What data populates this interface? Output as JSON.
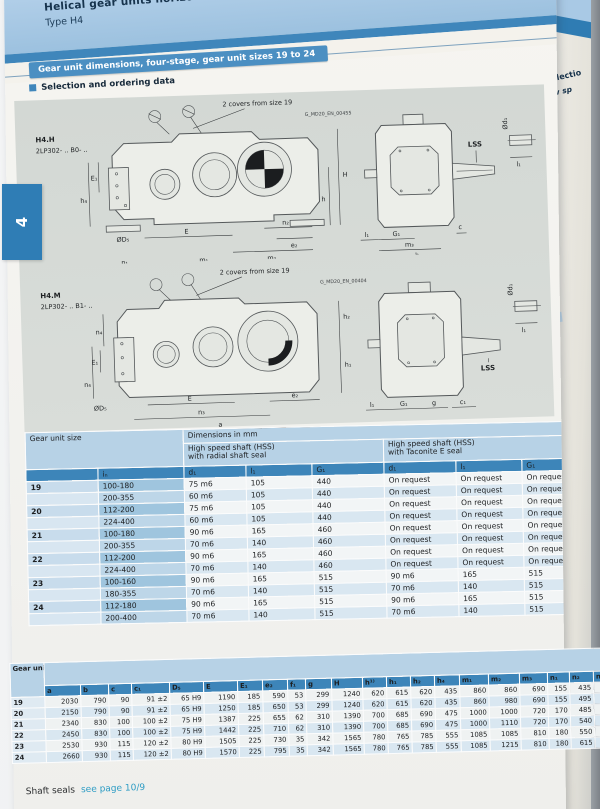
{
  "page_tab": "4",
  "header": {
    "title": "Helical gear units horizontal mounting positio",
    "subtitle": "Type H4",
    "banner": "Gear unit dimensions, four-stage, gear unit sizes 19 to 24",
    "section": "Selection and ordering data"
  },
  "drawing_top": {
    "model": "H4.H",
    "code": "2LP302- .. B0- ..",
    "note": "2 covers from size 19",
    "doc_id": "G_MD20_EN_00455",
    "lss": "LSS",
    "labels": {
      "E1": "E₁",
      "h4": "h₄",
      "n1": "n₁",
      "f1": "f₁",
      "m1": "m₁",
      "a": "a",
      "D5": "ØD₅",
      "E": "E",
      "n2": "n₂",
      "e2": "e₂",
      "m2": "m₂",
      "H": "H",
      "h": "h",
      "d1": "Ød₁",
      "l1": "l₁",
      "G1": "G₁",
      "m3": "m₃",
      "b": "b",
      "c": "c",
      "l1b": "l₁"
    }
  },
  "drawing_bottom": {
    "model": "H4.M",
    "code": "2LP302- .. B1- ..",
    "note": "2 covers from size 19",
    "doc_id": "G_MD20_EN_00404",
    "lss": "LSS",
    "labels": {
      "n4a": "n₄",
      "E1": "E₁",
      "n4b": "n₄",
      "D5": "ØD₅",
      "E": "E",
      "n3": "n₃",
      "a": "a",
      "e2": "e₂",
      "h2": "h₂",
      "h1": "h₁",
      "d1": "Ød₁",
      "l1": "l₁",
      "G1": "G₁",
      "g": "g",
      "c1": "c₁",
      "l1b": "l₁"
    }
  },
  "table1": {
    "corner": "Gear unit size",
    "dims_title": "Dimensions in mm",
    "group1a": "High speed shaft (HSS)",
    "group1b": "with radial shaft seal",
    "group2a": "High speed shaft (HSS)",
    "group2b": "with Taconite E seal",
    "cols": [
      "iₙ",
      "d₁",
      "l₁",
      "G₁",
      "d₁",
      "l₁",
      "G₁"
    ],
    "rows": [
      {
        "size": "19",
        "in": "100-180",
        "cells": [
          "75 m6",
          "105",
          "440",
          "On request",
          "On request",
          "On request"
        ]
      },
      {
        "size": "",
        "in": "200-355",
        "cells": [
          "60 m6",
          "105",
          "440",
          "On request",
          "On request",
          "On request"
        ]
      },
      {
        "size": "20",
        "in": "112-200",
        "cells": [
          "75 m6",
          "105",
          "440",
          "On request",
          "On request",
          "On request"
        ]
      },
      {
        "size": "",
        "in": "224-400",
        "cells": [
          "60 m6",
          "105",
          "440",
          "On request",
          "On request",
          "On request"
        ]
      },
      {
        "size": "21",
        "in": "100-180",
        "cells": [
          "90 m6",
          "165",
          "460",
          "On request",
          "On request",
          "On request"
        ]
      },
      {
        "size": "",
        "in": "200-355",
        "cells": [
          "70 m6",
          "140",
          "460",
          "On request",
          "On request",
          "On request"
        ]
      },
      {
        "size": "22",
        "in": "112-200",
        "cells": [
          "90 m6",
          "165",
          "460",
          "On request",
          "On request",
          "On request"
        ]
      },
      {
        "size": "",
        "in": "224-400",
        "cells": [
          "70 m6",
          "140",
          "460",
          "On request",
          "On request",
          "On request"
        ]
      },
      {
        "size": "23",
        "in": "100-160",
        "cells": [
          "90 m6",
          "165",
          "515",
          "90 m6",
          "165",
          "515"
        ]
      },
      {
        "size": "",
        "in": "180-355",
        "cells": [
          "70 m6",
          "140",
          "515",
          "70 m6",
          "140",
          "515"
        ]
      },
      {
        "size": "24",
        "in": "112-180",
        "cells": [
          "90 m6",
          "165",
          "515",
          "90 m6",
          "165",
          "515"
        ]
      },
      {
        "size": "",
        "in": "200-400",
        "cells": [
          "70 m6",
          "140",
          "515",
          "70 m6",
          "140",
          "515"
        ]
      }
    ]
  },
  "table2": {
    "corner": "Gear unit size",
    "cols": [
      "a",
      "b",
      "c",
      "c₁",
      "D₅",
      "E",
      "E₁",
      "e₂",
      "f₁",
      "g",
      "H",
      "h¹⁾",
      "h₁",
      "h₂",
      "h₄",
      "m₁",
      "m₂",
      "m₃",
      "n₁",
      "n₂",
      "n₃",
      "n₄"
    ],
    "rows": [
      {
        "size": "19",
        "cells": [
          "2030",
          "790",
          "90",
          "91 ±2",
          "65 H9",
          "1190",
          "185",
          "590",
          "53",
          "299",
          "1240",
          "620",
          "615",
          "620",
          "435",
          "860",
          "860",
          "690",
          "155",
          "435",
          "1365",
          "475"
        ]
      },
      {
        "size": "20",
        "cells": [
          "2150",
          "790",
          "90",
          "91 ±2",
          "65 H9",
          "1250",
          "185",
          "650",
          "53",
          "299",
          "1240",
          "620",
          "615",
          "620",
          "435",
          "860",
          "980",
          "690",
          "155",
          "495",
          "1425",
          "475"
        ]
      },
      {
        "size": "21",
        "cells": [
          "2340",
          "830",
          "100",
          "100 ±2",
          "75 H9",
          "1387",
          "225",
          "655",
          "62",
          "310",
          "1390",
          "700",
          "685",
          "690",
          "475",
          "1000",
          "1000",
          "720",
          "170",
          "485",
          "1600",
          "520"
        ]
      },
      {
        "size": "22",
        "cells": [
          "2450",
          "830",
          "100",
          "100 ±2",
          "75 H9",
          "1442",
          "225",
          "710",
          "62",
          "310",
          "1390",
          "700",
          "685",
          "690",
          "475",
          "1000",
          "1110",
          "720",
          "170",
          "540",
          "1655",
          "520"
        ]
      },
      {
        "size": "23",
        "cells": [
          "2530",
          "930",
          "115",
          "120 ±2",
          "80 H9",
          "1505",
          "225",
          "730",
          "35",
          "342",
          "1565",
          "780",
          "765",
          "785",
          "555",
          "1085",
          "1085",
          "810",
          "180",
          "550",
          "1725",
          "580"
        ]
      },
      {
        "size": "24",
        "cells": [
          "2660",
          "930",
          "115",
          "120 ±2",
          "80 H9",
          "1570",
          "225",
          "795",
          "35",
          "342",
          "1565",
          "780",
          "765",
          "785",
          "555",
          "1085",
          "1215",
          "810",
          "180",
          "615",
          "1790",
          "580"
        ]
      }
    ]
  },
  "footer": {
    "label": "Shaft seals",
    "link": "see page 10/9"
  },
  "next_page": {
    "t1": "Selectio",
    "t2": "Low sp",
    "type1": "Type",
    "m1": "H4SH",
    "type2": "Type",
    "m2": "H4D",
    "m3": "H4D"
  }
}
